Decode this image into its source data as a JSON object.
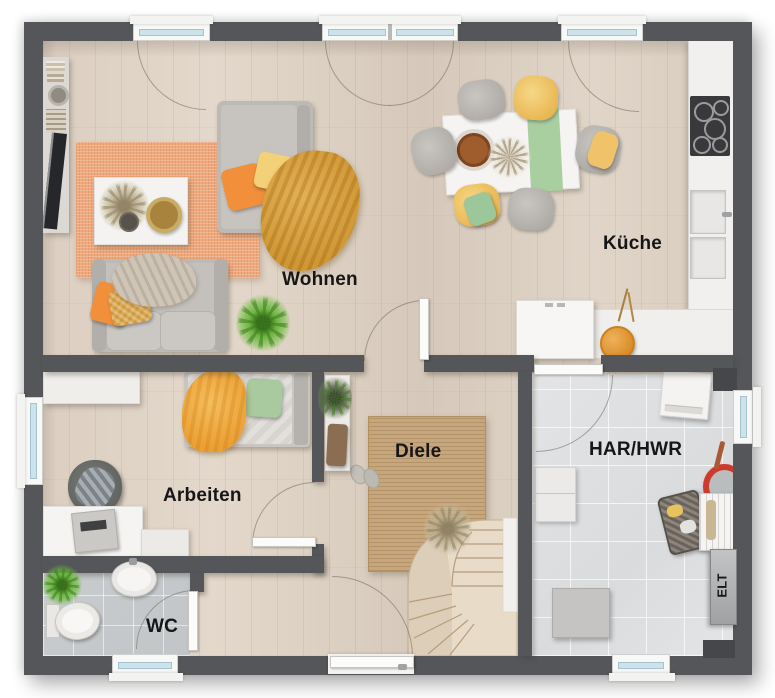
{
  "rooms": {
    "wohnen": {
      "label": "Wohnen"
    },
    "kueche": {
      "label": "Küche"
    },
    "arbeiten": {
      "label": "Arbeiten"
    },
    "diele": {
      "label": "Diele"
    },
    "wc": {
      "label": "WC"
    },
    "har_hwr": {
      "label": "HAR/HWR"
    },
    "elt": {
      "label": "ELT"
    }
  },
  "colors": {
    "wall": "#54565A",
    "wood_floor": "#DCCFC2",
    "tile_wc": "#C6C9CA",
    "tile_hwr": "#DFE1E2",
    "rug_wohnen": "#EEAA7E",
    "rug_diele": "#C7A67C",
    "window_glass": "#CDE3EC",
    "pillow_orange": "#F18F3B",
    "blanket_mustard": "#D9A243",
    "pillow_green": "#A8CA9E",
    "chair_yellow": "#F1C469",
    "bucket_red": "#CF3A2E"
  }
}
